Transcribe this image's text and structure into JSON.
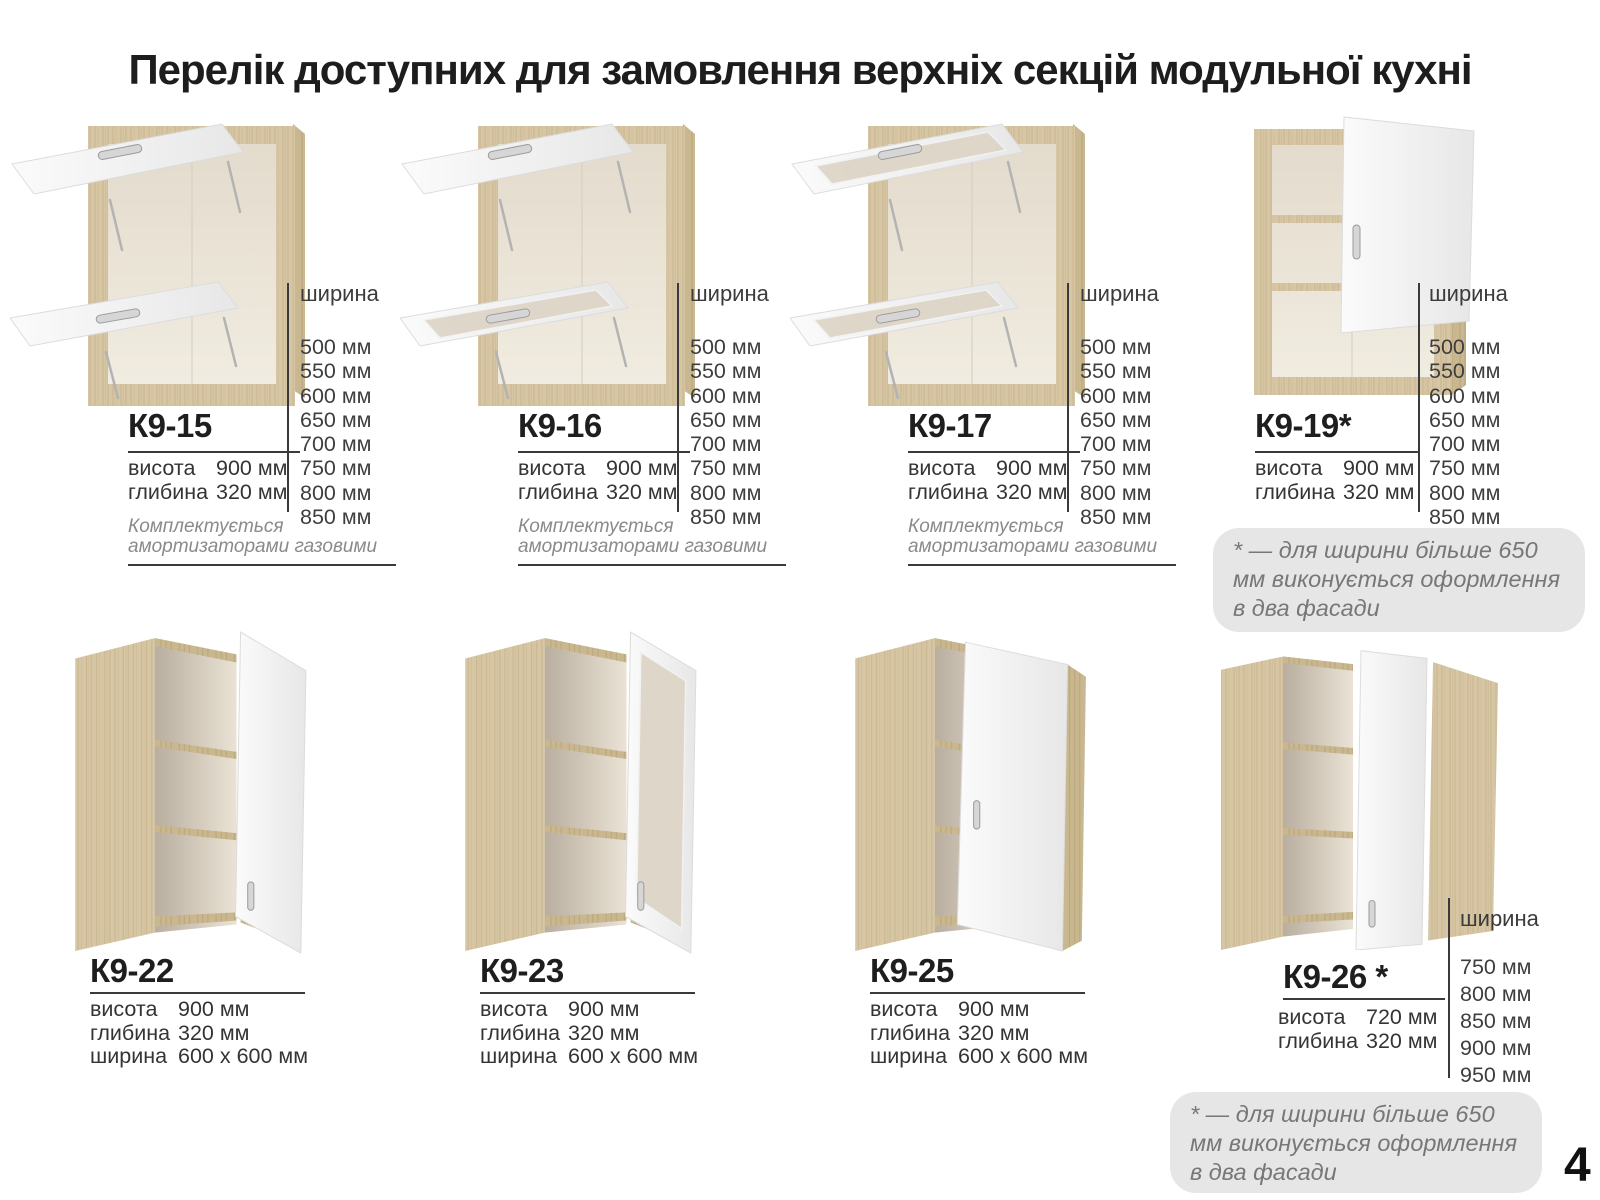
{
  "page": {
    "title": "Перелік доступних для замовлення верхніх секцій модульної кухні",
    "page_number": "4"
  },
  "labels": {
    "width": "ширина",
    "height": "висота",
    "depth": "глибина"
  },
  "notes": {
    "gas": "Комплектується амортизаторами газовими",
    "asterisk": "* — для ширини більше 650 мм виконується оформлення в два фасади"
  },
  "products": [
    {
      "model": "К9-15",
      "height": "900 мм",
      "depth": "320 мм",
      "widths": [
        "500 мм",
        "550 мм",
        "600 мм",
        "650 мм",
        "700 мм",
        "750 мм",
        "800 мм",
        "850 мм"
      ]
    },
    {
      "model": "К9-16",
      "height": "900 мм",
      "depth": "320 мм",
      "widths": [
        "500 мм",
        "550 мм",
        "600 мм",
        "650 мм",
        "700 мм",
        "750 мм",
        "800 мм",
        "850 мм"
      ]
    },
    {
      "model": "К9-17",
      "height": "900 мм",
      "depth": "320 мм",
      "widths": [
        "500 мм",
        "550 мм",
        "600 мм",
        "650 мм",
        "700 мм",
        "750 мм",
        "800 мм",
        "850 мм"
      ]
    },
    {
      "model": "К9-19*",
      "height": "900 мм",
      "depth": "320 мм",
      "widths": [
        "500 мм",
        "550 мм",
        "600 мм",
        "650 мм",
        "700 мм",
        "750 мм",
        "800 мм",
        "850 мм"
      ]
    },
    {
      "model": "К9-22",
      "height": "900 мм",
      "depth": "320 мм",
      "width": "600 x 600 мм"
    },
    {
      "model": "К9-23",
      "height": "900 мм",
      "depth": "320 мм",
      "width": "600 x 600 мм"
    },
    {
      "model": "К9-25",
      "height": "900 мм",
      "depth": "320 мм",
      "width": "600 x 600 мм"
    },
    {
      "model": "К9-26 *",
      "height": "720 мм",
      "depth": "320 мм",
      "widths": [
        "750 мм",
        "800 мм",
        "850 мм",
        "900 мм",
        "950 мм"
      ]
    }
  ],
  "colors": {
    "wood": "#d7c6a4",
    "wood_dark": "#c3b18c",
    "interior": "#efe9dd",
    "door_white": "#f4f4f4",
    "glass": "#ddd5c6",
    "text": "#303030",
    "divider": "#3a3a3a",
    "note_gray": "#8a8a8a",
    "note_box_bg": "#e6e6e6",
    "note_box_text": "#777777"
  }
}
